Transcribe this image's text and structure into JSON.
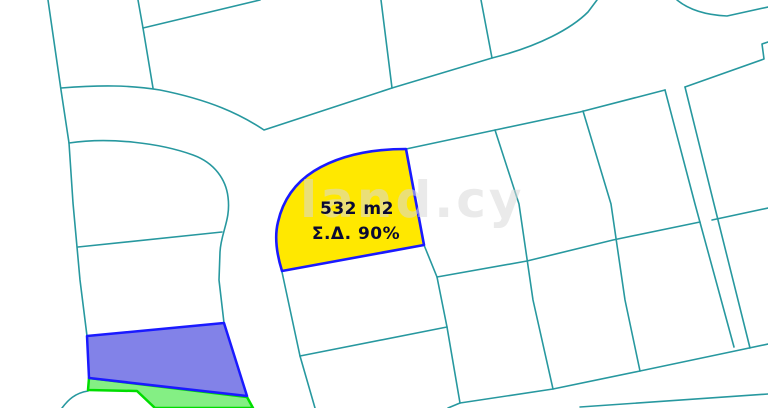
{
  "map": {
    "background": "#ffffff",
    "line_color": "#27989F",
    "watermark": {
      "text": "land.cy",
      "color": "#d9d9d9"
    },
    "highlighted_plot": {
      "area_label": "532 m2",
      "density_label": "Σ.Δ. 90%",
      "fill": "#FFE800",
      "border": "#1A1AFF",
      "text_color": "#0A0A33"
    },
    "blue_plot": {
      "fill": "#8282E8",
      "border": "#1A1AFF"
    },
    "green_plot": {
      "fill": "#84EF84",
      "border": "#00DD00"
    }
  }
}
